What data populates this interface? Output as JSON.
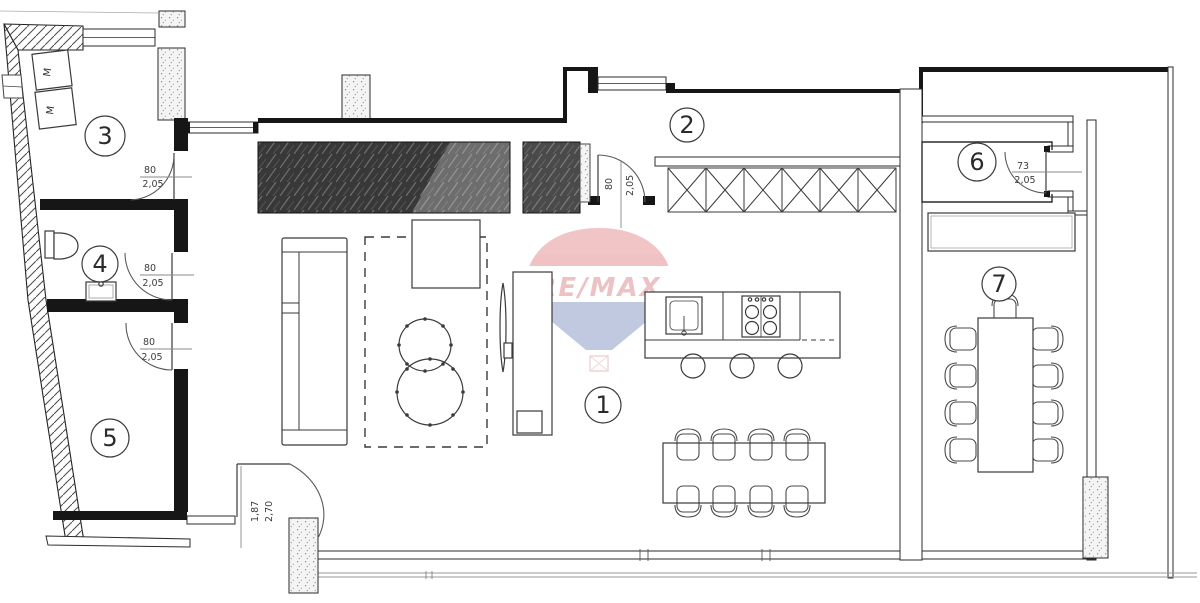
{
  "canvas": {
    "width": 1200,
    "height": 603,
    "background": "#ffffff"
  },
  "watermark": {
    "brand": "RE/MAX",
    "red": "#cf3a40",
    "blue": "#36519e",
    "opacity": 0.3
  },
  "rooms": {
    "r1": {
      "label": "1"
    },
    "r2": {
      "label": "2"
    },
    "r3": {
      "label": "3"
    },
    "r4": {
      "label": "4"
    },
    "r5": {
      "label": "5"
    },
    "r6": {
      "label": "6"
    },
    "r7": {
      "label": "7"
    }
  },
  "doors": {
    "room3": {
      "width": "80",
      "height": "2,05"
    },
    "room4": {
      "width": "80",
      "height": "2,05"
    },
    "room5": {
      "width": "80",
      "height": "2,05"
    },
    "hallway": {
      "width": "80",
      "height": "2,05"
    },
    "room6": {
      "width": "73",
      "height": "2,05"
    },
    "balcony": {
      "width": "1,87",
      "height": "2,70"
    }
  },
  "appliances": {
    "washer_label": "M"
  },
  "furniture": [
    "sofa",
    "rug",
    "coffee-table",
    "round-side-tables",
    "tv",
    "tv-cabinet",
    "built-in-wardrobe",
    "kitchen-upper-cabinets",
    "kitchen-island",
    "sink",
    "cooktop",
    "bar-stools",
    "dining-table",
    "dining-chairs",
    "terrace-table",
    "terrace-chairs",
    "toilet",
    "washbasin",
    "washing-machines"
  ],
  "colors": {
    "wall": "#161616",
    "line": "#2f2f2f",
    "light_line": "#9a9a9a",
    "wardrobe_dark": "#383838",
    "wardrobe_mid": "#6d6d6d",
    "column_fill": "#f4f4f4"
  }
}
